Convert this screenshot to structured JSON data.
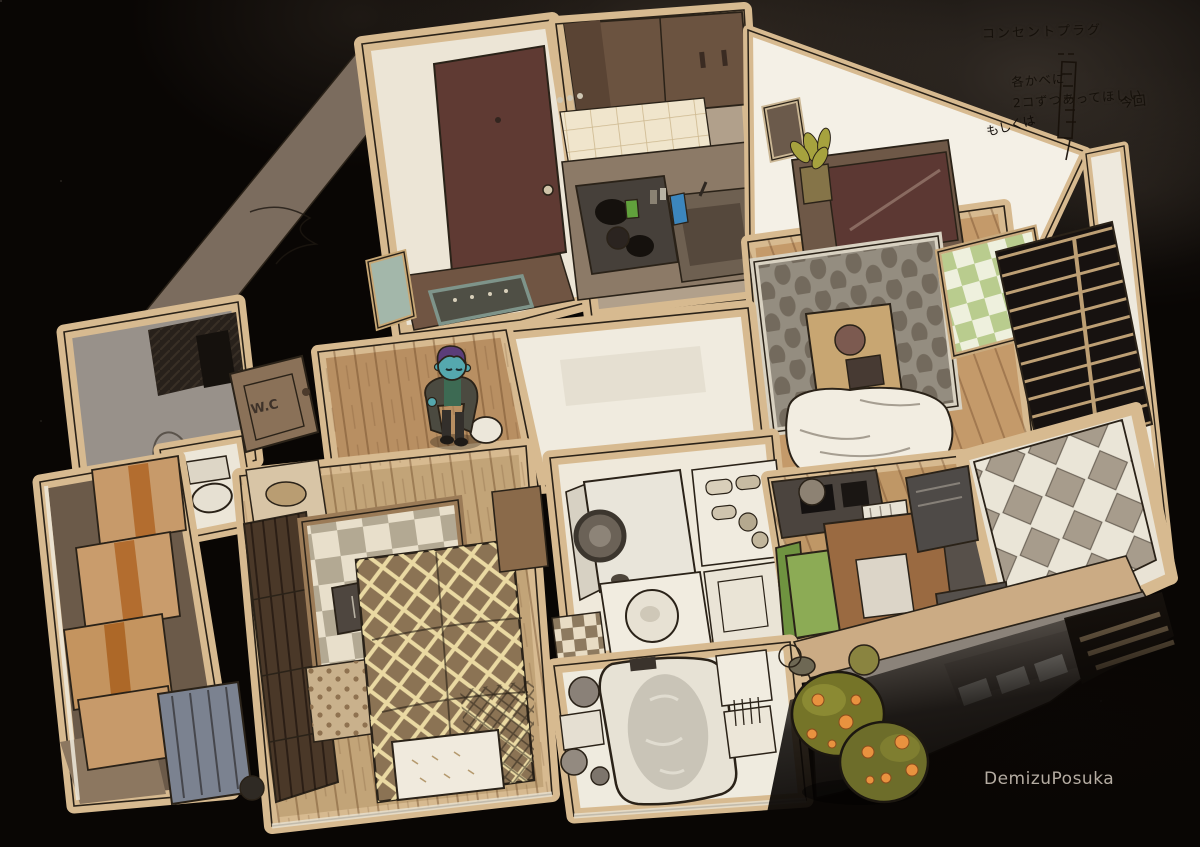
{
  "annotations": {
    "outlet_title": "コンセントプラグ",
    "wall_note_line1": "各かべに",
    "wall_note_line2": "2コずつあってほしい",
    "side_note": "今回",
    "alt_note": "もしくは"
  },
  "door_label": "W.C",
  "signature": "DemizuPosuka",
  "palette": {
    "background": "#090604",
    "wall_beige": "#d7ba90",
    "wall_white": "#f2eee3",
    "floor_wood": "#bb9164",
    "ink": "#2a2218",
    "bush_green": "#757428",
    "bush_fruit": "#e8923f",
    "character_skin": "#55a8ae",
    "character_hair": "#5b3d79",
    "chair_green": "#8cab55",
    "door_maroon": "#5f3a33"
  }
}
